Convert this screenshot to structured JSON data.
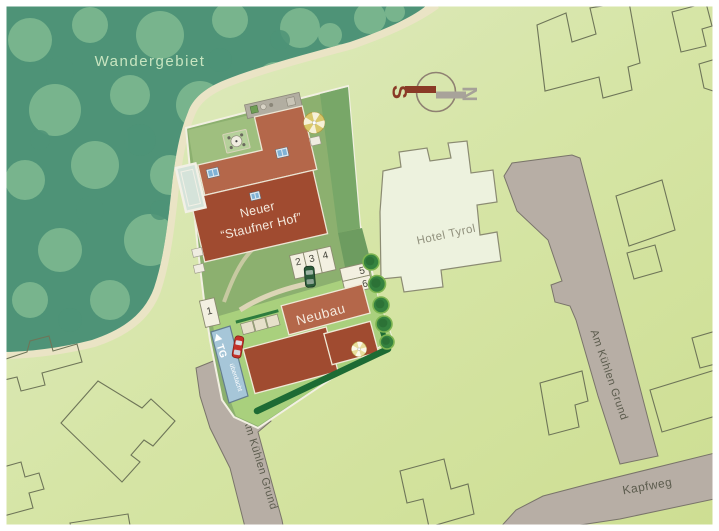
{
  "plan": {
    "region_label": "Wandergebiet",
    "compass": {
      "south": "S",
      "north": "N"
    },
    "buildings": {
      "main": {
        "line1": "Neuer",
        "line2": "“Staufner Hof”"
      },
      "hotel": "Hotel Tyrol",
      "neubau": "Neubau"
    },
    "garage": {
      "label": "TG",
      "note": "überdacht"
    },
    "parking": [
      "1",
      "2",
      "3",
      "4",
      "5",
      "6"
    ],
    "streets": {
      "am_kuehlen_grund_west": "Am Kühlen Grund",
      "am_kuehlen_grund_east": "Am Kühlen Grund",
      "kapfweg": "Kapfweg"
    },
    "colors": {
      "background": "#d6e5a6",
      "forest": "#4e9377",
      "forest_trees": "#9bcfa0",
      "site_green": "#8cb06f",
      "lawn": "#a9d07d",
      "roof_light": "#b4674a",
      "roof_dark": "#a04b30",
      "street": "#b7aea5",
      "hotel_fill": "#edf2de",
      "hedge": "#1d6b34",
      "garage_ramp": "#a6c6d8",
      "car_red": "#c43129",
      "car_green": "#2b5a39",
      "compass_south": "#8a3a26",
      "compass_north": "#a6a198"
    }
  }
}
